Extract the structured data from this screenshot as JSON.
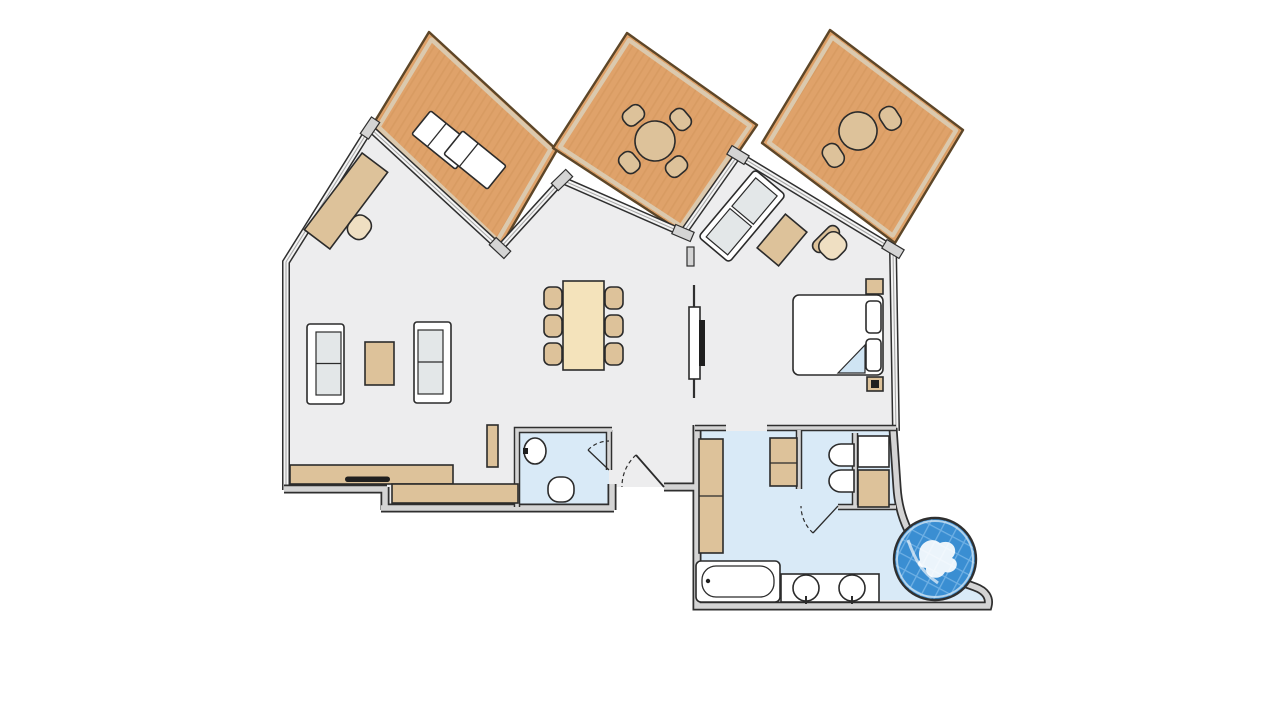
{
  "canvas": {
    "width": 1280,
    "height": 720,
    "background": "#ffffff"
  },
  "palette": {
    "background": "#ffffff",
    "floor": "#ededee",
    "bath_floor": "#d9eaf7",
    "wall_dark": "#2f2f2f",
    "wall_fill": "#d4d4d4",
    "glass_fill": "#f4f4f4",
    "glass_line": "#a9a9a9",
    "wood": "#dfa26a",
    "wood_grain": "#d2935a",
    "deck_band": "#dbc9ae",
    "deck_outline": "#5d4628",
    "tan": "#ddc29a",
    "tan_light": "#efdfc2",
    "cream": "#f4e3bb",
    "cushion": "#e3e7e8",
    "white": "#ffffff",
    "stroke": "#2b2b2b",
    "dark": "#1f1f1f",
    "fold": "#cfe4f3",
    "water": "#3a8ed2",
    "water_tile": "#6fb0e4",
    "water_swirl": "#ffffff"
  },
  "floor_plan": {
    "type": "apartment-suite-floor-plan",
    "terraces": [
      {
        "id": "terrace-left",
        "furniture": [
          "sun-lounger",
          "sun-lounger"
        ]
      },
      {
        "id": "terrace-middle",
        "furniture": [
          "round-dining-table",
          "chair",
          "chair",
          "chair",
          "chair"
        ]
      },
      {
        "id": "terrace-right",
        "furniture": [
          "round-table",
          "chair",
          "chair"
        ]
      }
    ],
    "rooms": [
      {
        "id": "living-dining-room",
        "furniture": [
          "desk",
          "desk-chair",
          "sofa",
          "sofa",
          "coffee-table",
          "dining-table",
          "dining-chair-x6",
          "kitchenette-counter",
          "counter-appliance",
          "tall-cabinet"
        ]
      },
      {
        "id": "bedroom",
        "furniture": [
          "double-bed",
          "pillow",
          "pillow",
          "nightstand",
          "nightstand",
          "tv-partition",
          "tv",
          "chaise-longue",
          "ottoman",
          "armchair"
        ]
      },
      {
        "id": "bathroom",
        "fixtures": [
          "wardrobe",
          "cabinet",
          "shower-tray",
          "toilet",
          "bidet",
          "stall-door",
          "bathtub",
          "double-washbasin",
          "whirlpool-tub"
        ]
      },
      {
        "id": "wc",
        "fixtures": [
          "washbasin",
          "toilet",
          "door"
        ]
      },
      {
        "id": "entry",
        "fixtures": [
          "entry-door"
        ]
      }
    ]
  }
}
